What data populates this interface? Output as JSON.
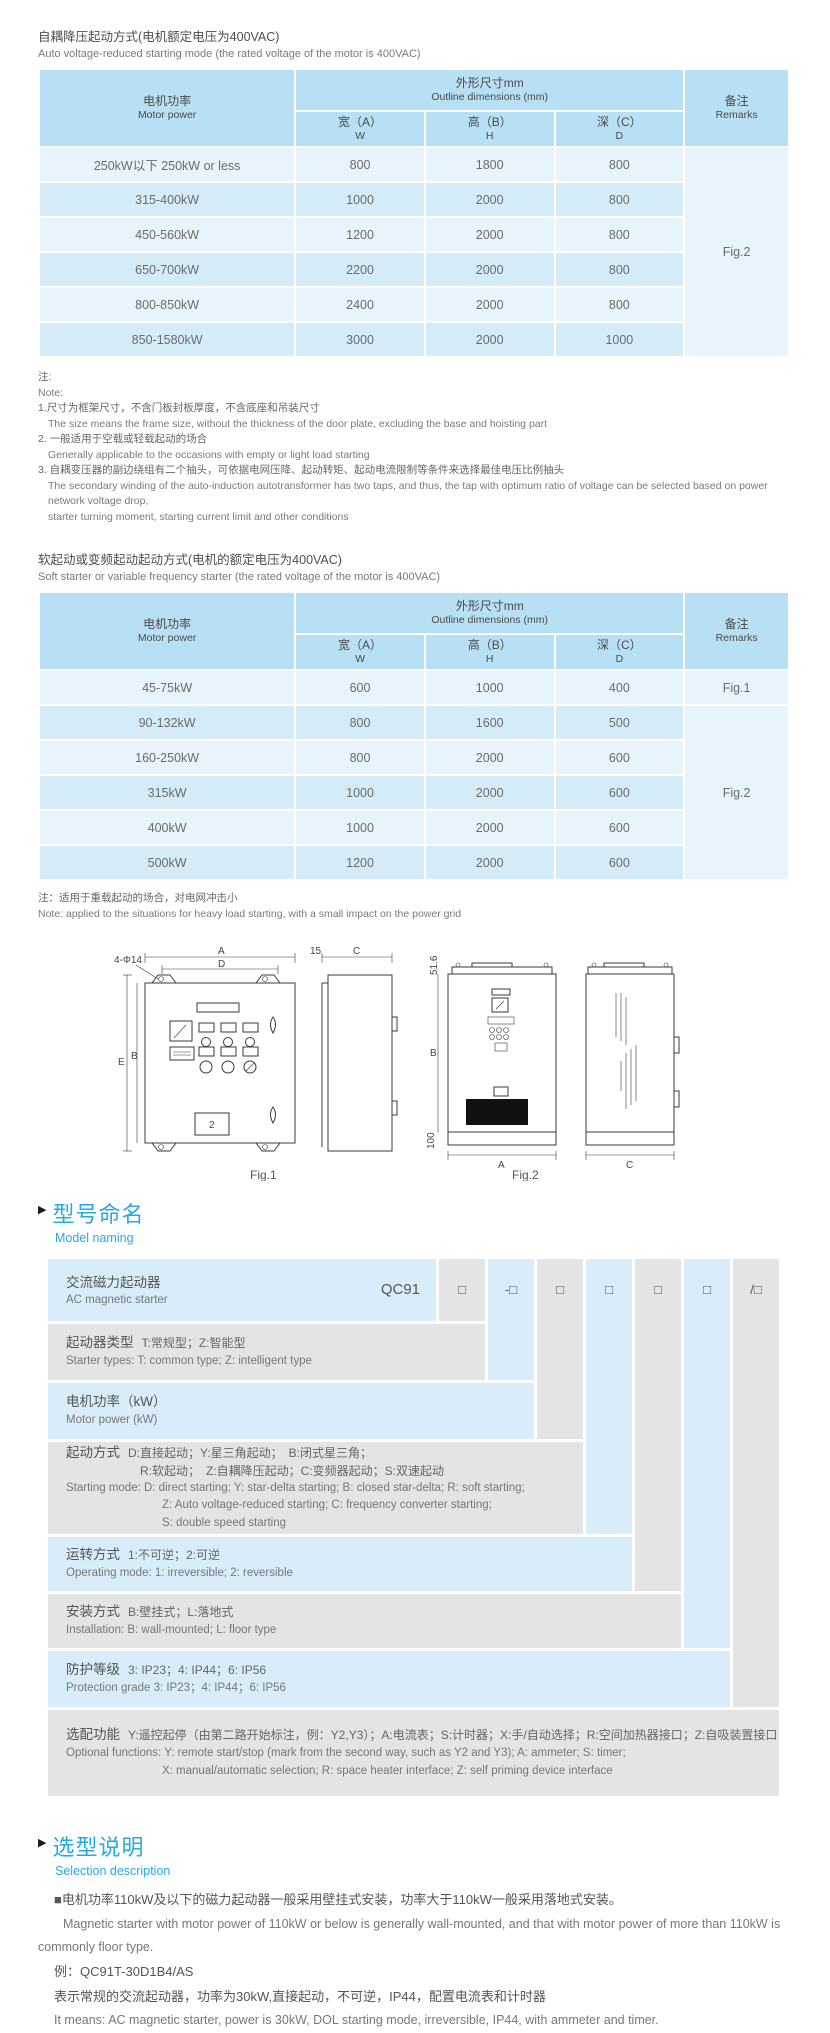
{
  "ui": {
    "section_marker": "▶"
  },
  "table1": {
    "title_cn": "自耦降压起动方式(电机额定电压为400VAC)",
    "title_en": "Auto voltage-reduced starting mode (the rated voltage of the motor is 400VAC)",
    "header": {
      "motor_cn": "电机功率",
      "motor_en": "Motor power",
      "outline_cn": "外形尺寸mm",
      "outline_en": "Outline dimensions (mm)",
      "w_cn": "宽（A）",
      "w_en": "W",
      "h_cn": "高（B）",
      "h_en": "H",
      "d_cn": "深（C）",
      "d_en": "D",
      "remarks_cn": "备注",
      "remarks_en": "Remarks"
    },
    "rows": [
      {
        "power": "250kW以下 250kW or less",
        "w": "800",
        "h": "1800",
        "d": "800"
      },
      {
        "power": "315-400kW",
        "w": "1000",
        "h": "2000",
        "d": "800"
      },
      {
        "power": "450-560kW",
        "w": "1200",
        "h": "2000",
        "d": "800"
      },
      {
        "power": "650-700kW",
        "w": "2200",
        "h": "2000",
        "d": "800"
      },
      {
        "power": "800-850kW",
        "w": "2400",
        "h": "2000",
        "d": "800"
      },
      {
        "power": "850-1580kW",
        "w": "3000",
        "h": "2000",
        "d": "1000"
      }
    ],
    "remark": "Fig.2"
  },
  "notes1": {
    "label_cn": "注:",
    "label_en": "Note:",
    "item1_cn": "1.尺寸为框架尺寸，不含门板封板厚度，不含底座和吊装尺寸",
    "item1_en": "The size means the frame size, without the thickness of the door plate, excluding the base and hoisting part",
    "item2_cn": "2. 一般适用于空载或轻载起动的场合",
    "item2_en": "Generally applicable to the occasions with empty or light load starting",
    "item3_cn": "3. 自耦变压器的副边绕组有二个抽头，可依据电网压降、起动转矩、起动电流限制等条件来选择最佳电压比例抽头",
    "item3_en1": "The secondary winding of the auto-induction autotransformer has two taps, and thus, the tap with optimum ratio of voltage can be selected based on power network voltage drop,",
    "item3_en2": "starter turning moment, starting current limit and other conditions"
  },
  "table2": {
    "title_cn": "软起动或变频起动起动方式(电机的额定电压为400VAC)",
    "title_en": "Soft starter or variable frequency starter (the rated voltage of the motor is 400VAC)",
    "rows": [
      {
        "power": "45-75kW",
        "w": "600",
        "h": "1000",
        "d": "400"
      },
      {
        "power": "90-132kW",
        "w": "800",
        "h": "1600",
        "d": "500"
      },
      {
        "power": "160-250kW",
        "w": "800",
        "h": "2000",
        "d": "600"
      },
      {
        "power": "315kW",
        "w": "1000",
        "h": "2000",
        "d": "600"
      },
      {
        "power": "400kW",
        "w": "1000",
        "h": "2000",
        "d": "600"
      },
      {
        "power": "500kW",
        "w": "1200",
        "h": "2000",
        "d": "600"
      }
    ],
    "remark_row1": "Fig.1",
    "remark_merged": "Fig.2"
  },
  "note2": {
    "cn": "注：适用于重载起动的场合，对电网冲击小",
    "en": "Note: applied to the situations for heavy load starting, with a small impact on the power grid"
  },
  "figures": {
    "fig1": {
      "caption": "Fig.1",
      "dim_a": "A",
      "dim_d": "D",
      "dim_e": "E",
      "dim_b": "B",
      "hole_note": "4-Φ14",
      "side_gap": "15",
      "dim_c": "C",
      "panel_num": "2"
    },
    "fig2": {
      "caption": "Fig.2",
      "dim_top": "51.6",
      "dim_b": "B",
      "dim_base": "100",
      "dim_a": "A",
      "dim_c": "C"
    }
  },
  "model_naming": {
    "title_cn": "型号命名",
    "title_en": "Model naming",
    "prefix": "QC91",
    "boxes": [
      "□",
      "-□",
      "□",
      "□",
      "□",
      "□",
      "/□"
    ],
    "rows": {
      "r0": {
        "label_cn": "交流磁力起动器",
        "en": "AC magnetic starter"
      },
      "r1": {
        "label_cn": "起动器类型",
        "desc_cn": "T:常规型；Z:智能型",
        "en": "Starter types: T: common type; Z: intelligent type"
      },
      "r2": {
        "label_cn": "电机功率（kW）",
        "en": "Motor power (kW)"
      },
      "r3": {
        "label_cn": "起动方式",
        "desc_cn1": "D:直接起动；Y:星三角起动；　B:闭式星三角；",
        "desc_cn2": "R:软起动；　Z:自耦降压起动；C:变频器起动；S:双速起动",
        "en1": "Starting mode: D: direct starting; Y: star-delta starting; B: closed star-delta; R: soft starting;",
        "en2": "Z: Auto voltage-reduced starting; C: frequency converter starting;",
        "en3": "S: double speed starting"
      },
      "r4": {
        "label_cn": "运转方式",
        "desc_cn": "1:不可逆；2:可逆",
        "en": "Operating mode: 1: irreversible; 2: reversible"
      },
      "r5": {
        "label_cn": "安装方式",
        "desc_cn": "B:壁挂式；L:落地式",
        "en": "Installation: B: wall-mounted;  L: floor type"
      },
      "r6": {
        "label_cn": "防护等级",
        "desc_cn": "3: IP23；4: IP44；6: IP56",
        "en": "Protection grade  3: IP23；4: IP44；6: IP56"
      },
      "r7": {
        "label_cn": "选配功能",
        "desc_cn": "Y:遥控起停（由第二路开始标注，例：Y2,Y3）；A:电流表；S:计时器；X:手/自动选择；R:空间加热器接口；Z:自吸装置接口",
        "en1": "Optional functions: Y: remote start/stop (mark from the second way, such as Y2 and Y3); A: ammeter; S: timer;",
        "en2": "X: manual/automatic selection; R: space heater interface; Z: self priming device interface"
      }
    }
  },
  "selection": {
    "title_cn": "选型说明",
    "title_en": "Selection description",
    "p1_cn": "■电机功率110kW及以下的磁力起动器一般采用壁挂式安装，功率大于110kW一般采用落地式安装。",
    "p1_en": "Magnetic starter with motor power of 110kW or below is generally wall-mounted, and that with motor power of more than 110kW is commonly floor type.",
    "example": "例：QC91T-30D1B4/AS",
    "p2_cn": "表示常规的交流起动器，功率为30kW,直接起动，不可逆，IP44，配置电流表和计时器",
    "p2_en": "It means: AC magnetic starter, power is 30kW, DOL starting mode, irreversible, IP44, with ammeter and timer."
  }
}
